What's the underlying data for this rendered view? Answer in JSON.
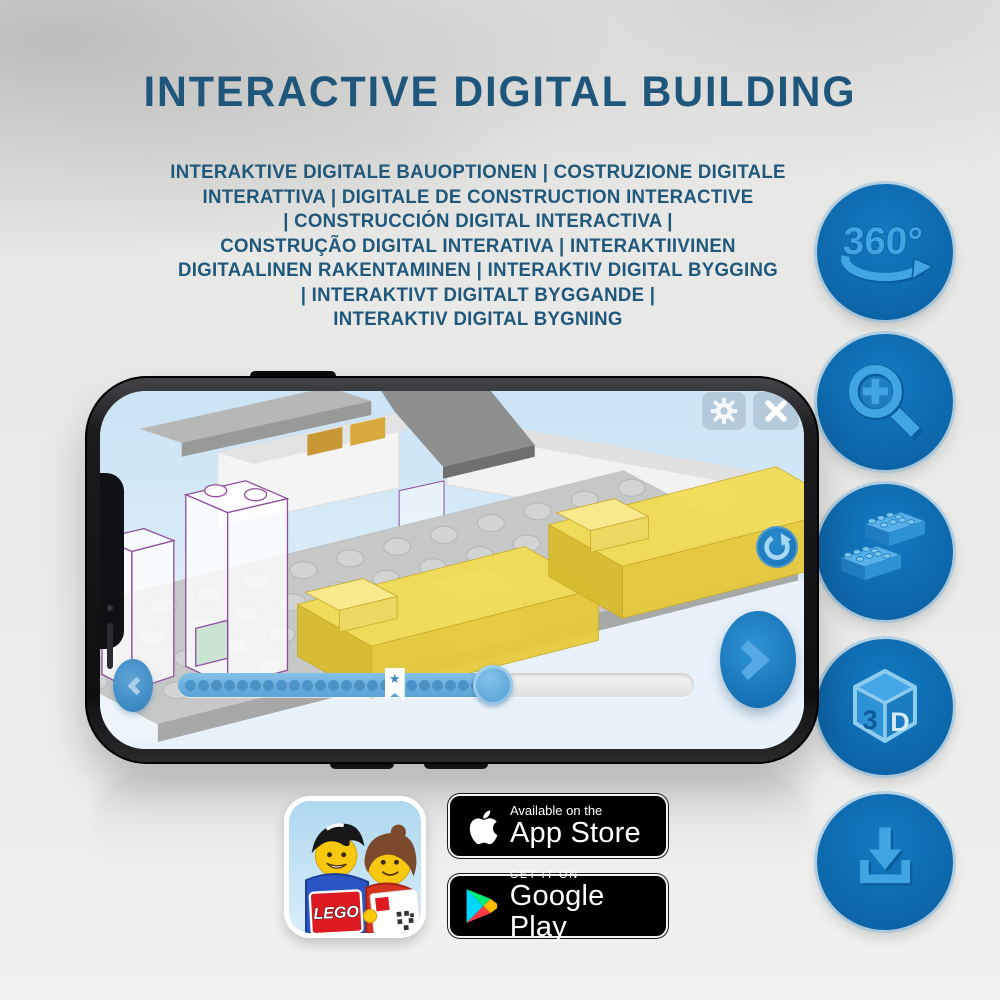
{
  "header": {
    "title": "INTERACTIVE DIGITAL BUILDING",
    "subtitle_lines": [
      "INTERAKTIVE DIGITALE BAUOPTIONEN | COSTRUZIONE DIGITALE",
      "INTERATTIVA | DIGITALE DE CONSTRUCTION INTERACTIVE",
      "| CONSTRUCCIÓN DIGITAL INTERACTIVA |",
      "CONSTRUÇÃO DIGITAL INTERATIVA | INTERAKTIIVINEN",
      "DIGITAALINEN RAKENTAMINEN | INTERAKTIV DIGITAL BYGGING",
      "| INTERAKTIVT DIGITALT BYGGANDE |",
      "INTERAKTIV DIGITAL BYGNING"
    ],
    "text_color": "#1f567c"
  },
  "feature_rail": {
    "circle_color": "#0d67ab",
    "icon_color": "#41a5e3",
    "items": [
      {
        "name": "360-rotation",
        "label": "360°"
      },
      {
        "name": "zoom-in-magnifier"
      },
      {
        "name": "stacking-bricks"
      },
      {
        "name": "3d-cube",
        "face_left": "3",
        "face_right": "D"
      },
      {
        "name": "download"
      }
    ]
  },
  "phone": {
    "screen_ui": {
      "progress": {
        "value_percent": 61,
        "bookmark_percent": 42,
        "dots": 23,
        "bookmark_glyph": "★"
      },
      "buttons": {
        "settings": "gear",
        "close": "x",
        "rotate": "rotate-arrow",
        "back": "chevron-left",
        "forward": "chevron-right"
      }
    }
  },
  "store_badges": {
    "app_store": {
      "line1": "Available on the",
      "line2": "App Store"
    },
    "google_play": {
      "line1": "GET IT ON",
      "line2": "Google Play"
    }
  },
  "app_icon": {
    "brand": "LEGO"
  }
}
